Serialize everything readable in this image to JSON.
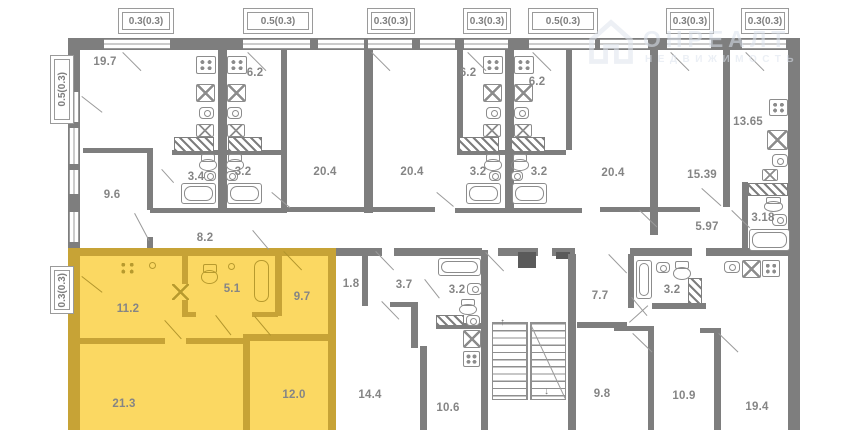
{
  "watermark": {
    "line1": "ОНРЕАЛТ",
    "line2": "НЕДВИЖИМОСТЬ"
  },
  "balconies": {
    "top": [
      "0.3(0.3)",
      "0.5(0.3)",
      "0.3(0.3)",
      "0.3(0.3)",
      "0.5(0.3)",
      "0.3(0.3)",
      "0.3(0.3)"
    ],
    "left_upper": "0.5(0.3)",
    "left_lower": "0.3(0.3)"
  },
  "rooms": {
    "living_19_7": "19.7",
    "kitchen_6_2_a": "6.2",
    "kitchen_6_2_b": "6.2",
    "kitchen_6_2_c": "6.2",
    "kitchen_13_65": "13.65",
    "room_9_6": "9.6",
    "bath_3_4": "3.4",
    "bath_3_2_a": "3.2",
    "room_20_4_a": "20.4",
    "room_20_4_b": "20.4",
    "bath_3_2_b": "3.2",
    "bath_3_2_c": "3.2",
    "room_20_4_c": "20.4",
    "room_15_39": "15.39",
    "hall_8_2": "8.2",
    "hall_5_97": "5.97",
    "bath_3_18": "3.18",
    "kitchen_11_2": "11.2",
    "bath_5_1": "5.1",
    "hall_9_7": "9.7",
    "room_21_3": "21.3",
    "room_12_0": "12.0",
    "hall_1_8": "1.8",
    "hall_3_7": "3.7",
    "bath_3_2_d": "3.2",
    "room_14_4": "14.4",
    "kitchen_10_6": "10.6",
    "room_7_7": "7.7",
    "bath_3_2_e": "3.2",
    "room_9_8": "9.8",
    "room_10_9": "10.9",
    "room_19_4": "19.4"
  },
  "icons": {
    "stairs_up": "↑",
    "stairs_down": "↓"
  },
  "colors": {
    "wall": "#7e7e7e",
    "ywall": "#c7a336",
    "yfill": "#fbd862",
    "label": "#858585",
    "wm": "#dce3ed"
  }
}
